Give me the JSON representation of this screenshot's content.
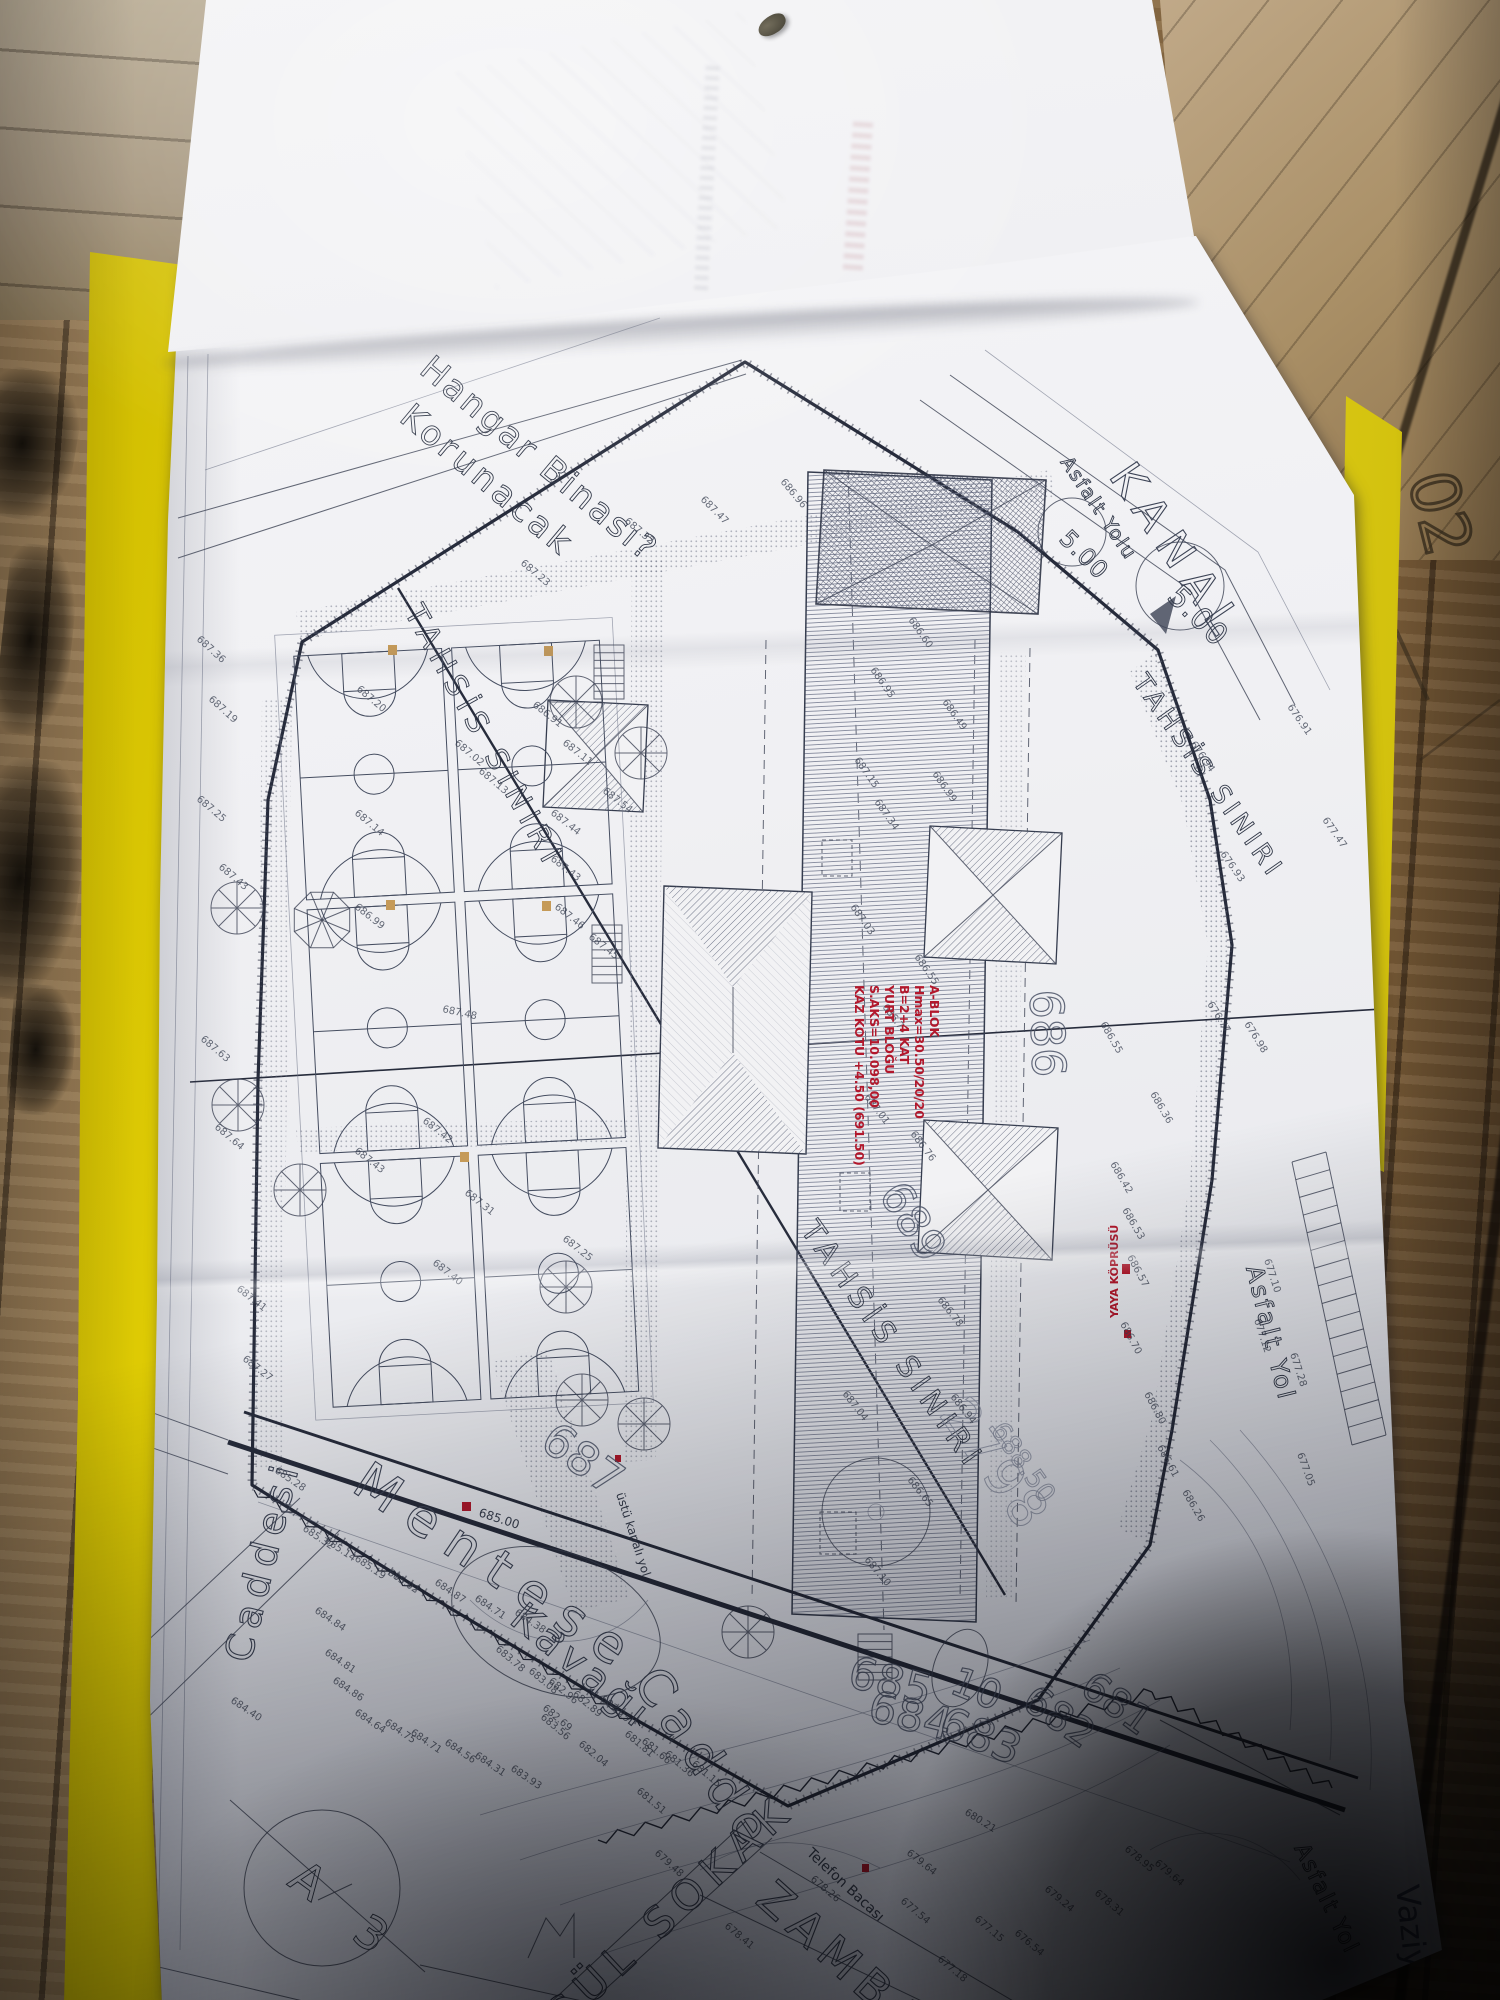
{
  "document": {
    "type": "site-plan-photo",
    "sheet_note_corner": "Vaziyet",
    "wood_mark": "02"
  },
  "plan": {
    "labels": [
      {
        "id": "note-hangar-1",
        "t": "Hangar Binası?",
        "x": 418,
        "y": 372,
        "r": 40,
        "s": 34,
        "c": "h",
        "ls": 3
      },
      {
        "id": "note-hangar-2",
        "t": "Korunacak",
        "x": 398,
        "y": 420,
        "r": 40,
        "s": 34,
        "c": "h",
        "ls": 4
      },
      {
        "id": "tahsis-left",
        "t": "TAHSİS SINIRI",
        "x": 404,
        "y": 612,
        "r": 61,
        "s": 30,
        "c": "h",
        "ls": 7
      },
      {
        "id": "tahsis-mid",
        "t": "TAHSİS SINIRI",
        "x": 800,
        "y": 1230,
        "r": 55,
        "s": 30,
        "c": "h",
        "ls": 7
      },
      {
        "id": "tahsis-right",
        "t": "TAHSİS SINIRI",
        "x": 1132,
        "y": 682,
        "r": 55,
        "s": 26,
        "c": "h",
        "ls": 5
      },
      {
        "id": "kanal",
        "t": "KANAL",
        "x": 1108,
        "y": 476,
        "r": 56,
        "s": 44,
        "c": "o",
        "ls": 12
      },
      {
        "id": "asfalt-top",
        "t": "Asfalt Yolu",
        "x": 1060,
        "y": 462,
        "r": 56,
        "s": 19,
        "c": "h",
        "ls": 2
      },
      {
        "id": "circle-500-a",
        "t": "5.00",
        "x": 1166,
        "y": 598,
        "r": 45,
        "s": 30,
        "c": "h",
        "ls": 1
      },
      {
        "id": "circle-500-b",
        "t": "5.00",
        "x": 1058,
        "y": 540,
        "r": 45,
        "s": 24,
        "c": "h",
        "ls": 1
      },
      {
        "id": "asfalt-right",
        "t": "Asfalt Yol",
        "x": 1246,
        "y": 1268,
        "r": 76,
        "s": 24,
        "c": "h",
        "ls": 3
      },
      {
        "id": "asfalt-bottom",
        "t": "Asfalt Yol",
        "x": 1294,
        "y": 1848,
        "r": 64,
        "s": 22,
        "c": "h",
        "ls": 2
      },
      {
        "id": "street-mentese",
        "t": "Menteşe",
        "x": 350,
        "y": 1490,
        "r": 34,
        "s": 52,
        "c": "o",
        "ls": 16
      },
      {
        "id": "street-kavagi",
        "t": "Kavağı",
        "x": 508,
        "y": 1622,
        "r": 40,
        "s": 40,
        "c": "o",
        "ls": 6
      },
      {
        "id": "street-cadde",
        "t": "Cadde",
        "x": 632,
        "y": 1682,
        "r": 56,
        "s": 50,
        "c": "o",
        "ls": 10
      },
      {
        "id": "street-caddesi-left",
        "t": "Caddesi",
        "x": 250,
        "y": 1664,
        "r": -76,
        "s": 38,
        "c": "o",
        "ls": 8
      },
      {
        "id": "street-gul-sokak",
        "t": "GÜL SOKAK",
        "x": 560,
        "y": 2034,
        "r": -43,
        "s": 42,
        "c": "o",
        "ls": 9
      },
      {
        "id": "street-zambak",
        "t": "ZAMBAK",
        "x": 754,
        "y": 1902,
        "r": 42,
        "s": 46,
        "c": "o",
        "ls": 9
      },
      {
        "id": "telefon-bacasi",
        "t": "Telefon Bacası",
        "x": 806,
        "y": 1854,
        "r": 43,
        "s": 14,
        "c": "p"
      },
      {
        "id": "ustu-kapali-yol",
        "t": "üstü kapalı yol",
        "x": 616,
        "y": 1494,
        "r": 72,
        "s": 12,
        "c": "p"
      },
      {
        "id": "contour-685",
        "t": "685",
        "x": 846,
        "y": 1686,
        "r": 14,
        "s": 44,
        "c": "b"
      },
      {
        "id": "contour-684",
        "t": "684",
        "x": 866,
        "y": 1720,
        "r": 14,
        "s": 44,
        "c": "b"
      },
      {
        "id": "contour-683",
        "t": "683",
        "x": 936,
        "y": 1734,
        "r": 22,
        "s": 44,
        "c": "b"
      },
      {
        "id": "contour-682",
        "t": "682",
        "x": 1020,
        "y": 1706,
        "r": 35,
        "s": 40,
        "c": "b"
      },
      {
        "id": "contour-681",
        "t": "681",
        "x": 1078,
        "y": 1692,
        "r": 36,
        "s": 40,
        "c": "b"
      },
      {
        "id": "parcel-10",
        "t": "10",
        "x": 948,
        "y": 1692,
        "r": 22,
        "s": 40,
        "c": "b"
      },
      {
        "id": "contour-687",
        "t": "687",
        "x": 538,
        "y": 1446,
        "r": 36,
        "s": 46,
        "c": "b"
      },
      {
        "id": "contour-689",
        "t": "689",
        "x": 878,
        "y": 1194,
        "r": 58,
        "s": 44,
        "c": "b"
      },
      {
        "id": "contour-686",
        "t": "686",
        "x": 1030,
        "y": 990,
        "r": 88,
        "s": 46,
        "c": "b"
      },
      {
        "id": "parcel-2798",
        "t": "2798",
        "x": 938,
        "y": 1414,
        "r": 55,
        "s": 52,
        "c": "f",
        "ls": 4
      },
      {
        "id": "level-68850",
        "t": "688.50",
        "x": 990,
        "y": 1430,
        "r": 55,
        "s": 26,
        "c": "f"
      },
      {
        "id": "block-a3-letter",
        "t": "A",
        "x": 286,
        "y": 1884,
        "r": 36,
        "s": 46,
        "c": "h"
      },
      {
        "id": "block-a3-number",
        "t": "3",
        "x": 350,
        "y": 1938,
        "r": 36,
        "s": 46,
        "c": "h"
      },
      {
        "id": "tk-685",
        "t": "685.00",
        "x": 478,
        "y": 1516,
        "r": 18,
        "s": 12,
        "c": "p"
      },
      {
        "id": "yaya-koprusu",
        "t": "YAYA KÖPRÜSÜ",
        "x": 1118,
        "y": 1318,
        "r": -90,
        "s": 11,
        "c": "r"
      },
      {
        "id": "pen-vaziyet",
        "t": "Vaziyet",
        "x": 1396,
        "y": 1886,
        "r": 84,
        "s": 32,
        "c": "pen"
      },
      {
        "id": "wood-02",
        "t": "02",
        "x": 1408,
        "y": 478,
        "r": 76,
        "s": 66,
        "c": "wood"
      }
    ],
    "red_block": {
      "x": 930,
      "y": 985,
      "lines": [
        "A-BLOK",
        "Hmax=30.50/20/20",
        "B=2+4 KAT",
        "YURT BLOĞU",
        "S.AKS=10.098,00",
        "KAZ KOTU +4.50 (691.50)"
      ]
    },
    "elevations": [
      {
        "v": "687.36",
        "x": 196,
        "y": 640,
        "r": 42
      },
      {
        "v": "687.19",
        "x": 208,
        "y": 700,
        "r": 42
      },
      {
        "v": "687.25",
        "x": 196,
        "y": 800,
        "r": 40
      },
      {
        "v": "687.43",
        "x": 218,
        "y": 868,
        "r": 40
      },
      {
        "v": "687.63",
        "x": 200,
        "y": 1040,
        "r": 40
      },
      {
        "v": "687.64",
        "x": 214,
        "y": 1128,
        "r": 40
      },
      {
        "v": "687.41",
        "x": 236,
        "y": 1290,
        "r": 38
      },
      {
        "v": "687.27",
        "x": 242,
        "y": 1360,
        "r": 38
      },
      {
        "v": "687.20",
        "x": 356,
        "y": 690,
        "r": 40
      },
      {
        "v": "686.91",
        "x": 532,
        "y": 706,
        "r": 38
      },
      {
        "v": "687.02",
        "x": 454,
        "y": 744,
        "r": 40
      },
      {
        "v": "687.11",
        "x": 562,
        "y": 744,
        "r": 38
      },
      {
        "v": "687.14",
        "x": 354,
        "y": 814,
        "r": 40
      },
      {
        "v": "687.44",
        "x": 550,
        "y": 814,
        "r": 38
      },
      {
        "v": "687.43",
        "x": 550,
        "y": 860,
        "r": 38
      },
      {
        "v": "687.46",
        "x": 554,
        "y": 908,
        "r": 38
      },
      {
        "v": "687.45",
        "x": 588,
        "y": 938,
        "r": 38
      },
      {
        "v": "687.54",
        "x": 602,
        "y": 792,
        "r": 38
      },
      {
        "v": "687.13",
        "x": 478,
        "y": 772,
        "r": 40
      },
      {
        "v": "686.99",
        "x": 354,
        "y": 908,
        "r": 38
      },
      {
        "v": "687.48",
        "x": 442,
        "y": 1012,
        "r": 12
      },
      {
        "v": "687.42",
        "x": 422,
        "y": 1122,
        "r": 38
      },
      {
        "v": "687.43",
        "x": 354,
        "y": 1152,
        "r": 38
      },
      {
        "v": "687.31",
        "x": 464,
        "y": 1194,
        "r": 38
      },
      {
        "v": "687.25",
        "x": 562,
        "y": 1240,
        "r": 38
      },
      {
        "v": "687.40",
        "x": 432,
        "y": 1264,
        "r": 38
      },
      {
        "v": "687.23",
        "x": 520,
        "y": 564,
        "r": 40
      },
      {
        "v": "687.32",
        "x": 624,
        "y": 522,
        "r": 40
      },
      {
        "v": "687.47",
        "x": 700,
        "y": 500,
        "r": 45
      },
      {
        "v": "686.96",
        "x": 780,
        "y": 482,
        "r": 50
      },
      {
        "v": "686.95",
        "x": 870,
        "y": 670,
        "r": 55
      },
      {
        "v": "686.60",
        "x": 908,
        "y": 620,
        "r": 55
      },
      {
        "v": "686.49",
        "x": 942,
        "y": 702,
        "r": 55
      },
      {
        "v": "687.15",
        "x": 854,
        "y": 760,
        "r": 55
      },
      {
        "v": "687.34",
        "x": 874,
        "y": 802,
        "r": 55
      },
      {
        "v": "686.99",
        "x": 932,
        "y": 774,
        "r": 55
      },
      {
        "v": "687.03",
        "x": 850,
        "y": 907,
        "r": 55
      },
      {
        "v": "686.77",
        "x": 882,
        "y": 1007,
        "r": 53
      },
      {
        "v": "686.55",
        "x": 914,
        "y": 957,
        "r": 55
      },
      {
        "v": "687.01",
        "x": 864,
        "y": 1097,
        "r": 53
      },
      {
        "v": "686.76",
        "x": 910,
        "y": 1134,
        "r": 53
      },
      {
        "v": "686.94",
        "x": 950,
        "y": 1397,
        "r": 52
      },
      {
        "v": "686.65",
        "x": 907,
        "y": 1480,
        "r": 52
      },
      {
        "v": "687.04",
        "x": 842,
        "y": 1394,
        "r": 52
      },
      {
        "v": "687.10",
        "x": 864,
        "y": 1560,
        "r": 50
      },
      {
        "v": "686.78",
        "x": 937,
        "y": 1300,
        "r": 52
      },
      {
        "v": "686.42",
        "x": 1110,
        "y": 1164,
        "r": 60
      },
      {
        "v": "686.53",
        "x": 1122,
        "y": 1210,
        "r": 60
      },
      {
        "v": "686.57",
        "x": 1127,
        "y": 1257,
        "r": 62
      },
      {
        "v": "686.70",
        "x": 1120,
        "y": 1324,
        "r": 62
      },
      {
        "v": "686.36",
        "x": 1150,
        "y": 1094,
        "r": 60
      },
      {
        "v": "686.80",
        "x": 1144,
        "y": 1394,
        "r": 62
      },
      {
        "v": "686.61",
        "x": 1157,
        "y": 1447,
        "r": 62
      },
      {
        "v": "686.26",
        "x": 1182,
        "y": 1492,
        "r": 60
      },
      {
        "v": "686.55",
        "x": 1100,
        "y": 1024,
        "r": 60
      },
      {
        "v": "676.94",
        "x": 1190,
        "y": 744,
        "r": 55
      },
      {
        "v": "676.93",
        "x": 1220,
        "y": 854,
        "r": 55
      },
      {
        "v": "676.77",
        "x": 1207,
        "y": 1004,
        "r": 58
      },
      {
        "v": "676.98",
        "x": 1244,
        "y": 1024,
        "r": 58
      },
      {
        "v": "676.91",
        "x": 1287,
        "y": 707,
        "r": 55
      },
      {
        "v": "677.47",
        "x": 1322,
        "y": 820,
        "r": 55
      },
      {
        "v": "677.10",
        "x": 1264,
        "y": 1260,
        "r": 72
      },
      {
        "v": "677.28",
        "x": 1290,
        "y": 1354,
        "r": 72
      },
      {
        "v": "677.05",
        "x": 1297,
        "y": 1454,
        "r": 70
      },
      {
        "v": "677.12",
        "x": 1254,
        "y": 1320,
        "r": 72
      },
      {
        "v": "685.28",
        "x": 274,
        "y": 1472,
        "r": 34
      },
      {
        "v": "685.32",
        "x": 302,
        "y": 1530,
        "r": 34
      },
      {
        "v": "685.14",
        "x": 324,
        "y": 1542,
        "r": 34
      },
      {
        "v": "685.19",
        "x": 354,
        "y": 1560,
        "r": 34
      },
      {
        "v": "685.02",
        "x": 387,
        "y": 1574,
        "r": 34
      },
      {
        "v": "684.87",
        "x": 434,
        "y": 1584,
        "r": 34
      },
      {
        "v": "684.71",
        "x": 474,
        "y": 1600,
        "r": 34
      },
      {
        "v": "684.38",
        "x": 514,
        "y": 1614,
        "r": 34
      },
      {
        "v": "684.84",
        "x": 314,
        "y": 1612,
        "r": 34
      },
      {
        "v": "684.81",
        "x": 324,
        "y": 1654,
        "r": 34
      },
      {
        "v": "684.86",
        "x": 332,
        "y": 1682,
        "r": 34
      },
      {
        "v": "684.64",
        "x": 354,
        "y": 1714,
        "r": 34
      },
      {
        "v": "684.75",
        "x": 384,
        "y": 1724,
        "r": 34
      },
      {
        "v": "684.71",
        "x": 410,
        "y": 1734,
        "r": 34
      },
      {
        "v": "684.56",
        "x": 444,
        "y": 1744,
        "r": 34
      },
      {
        "v": "684.31",
        "x": 474,
        "y": 1757,
        "r": 34
      },
      {
        "v": "683.93",
        "x": 510,
        "y": 1770,
        "r": 34
      },
      {
        "v": "684.40",
        "x": 230,
        "y": 1702,
        "r": 34
      },
      {
        "v": "683.78",
        "x": 495,
        "y": 1650,
        "r": 40
      },
      {
        "v": "683.56",
        "x": 540,
        "y": 1718,
        "r": 40
      },
      {
        "v": "683.08",
        "x": 528,
        "y": 1672,
        "r": 40
      },
      {
        "v": "682.96",
        "x": 548,
        "y": 1682,
        "r": 40
      },
      {
        "v": "682.89",
        "x": 572,
        "y": 1695,
        "r": 40
      },
      {
        "v": "682.25",
        "x": 600,
        "y": 1700,
        "r": 40
      },
      {
        "v": "682.69",
        "x": 542,
        "y": 1709,
        "r": 40
      },
      {
        "v": "682.04",
        "x": 578,
        "y": 1745,
        "r": 40
      },
      {
        "v": "681.81",
        "x": 624,
        "y": 1735,
        "r": 40
      },
      {
        "v": "681.66",
        "x": 641,
        "y": 1742,
        "r": 40
      },
      {
        "v": "681.36",
        "x": 664,
        "y": 1755,
        "r": 40
      },
      {
        "v": "681.51",
        "x": 636,
        "y": 1792,
        "r": 40
      },
      {
        "v": "681.15",
        "x": 691,
        "y": 1765,
        "r": 40
      },
      {
        "v": "680.21",
        "x": 964,
        "y": 1814,
        "r": 32
      },
      {
        "v": "679.64",
        "x": 906,
        "y": 1854,
        "r": 38
      },
      {
        "v": "679.48",
        "x": 654,
        "y": 1854,
        "r": 42
      },
      {
        "v": "678.41",
        "x": 724,
        "y": 1927,
        "r": 40
      },
      {
        "v": "678.26",
        "x": 810,
        "y": 1880,
        "r": 40
      },
      {
        "v": "677.54",
        "x": 900,
        "y": 1902,
        "r": 40
      },
      {
        "v": "677.18",
        "x": 937,
        "y": 1960,
        "r": 40
      },
      {
        "v": "677.15",
        "x": 974,
        "y": 1920,
        "r": 40
      },
      {
        "v": "676.54",
        "x": 1014,
        "y": 1934,
        "r": 40
      },
      {
        "v": "679.24",
        "x": 1044,
        "y": 1890,
        "r": 40
      },
      {
        "v": "678.31",
        "x": 1094,
        "y": 1894,
        "r": 40
      },
      {
        "v": "678.95",
        "x": 1124,
        "y": 1850,
        "r": 40
      },
      {
        "v": "679.64",
        "x": 1154,
        "y": 1864,
        "r": 40
      }
    ]
  }
}
